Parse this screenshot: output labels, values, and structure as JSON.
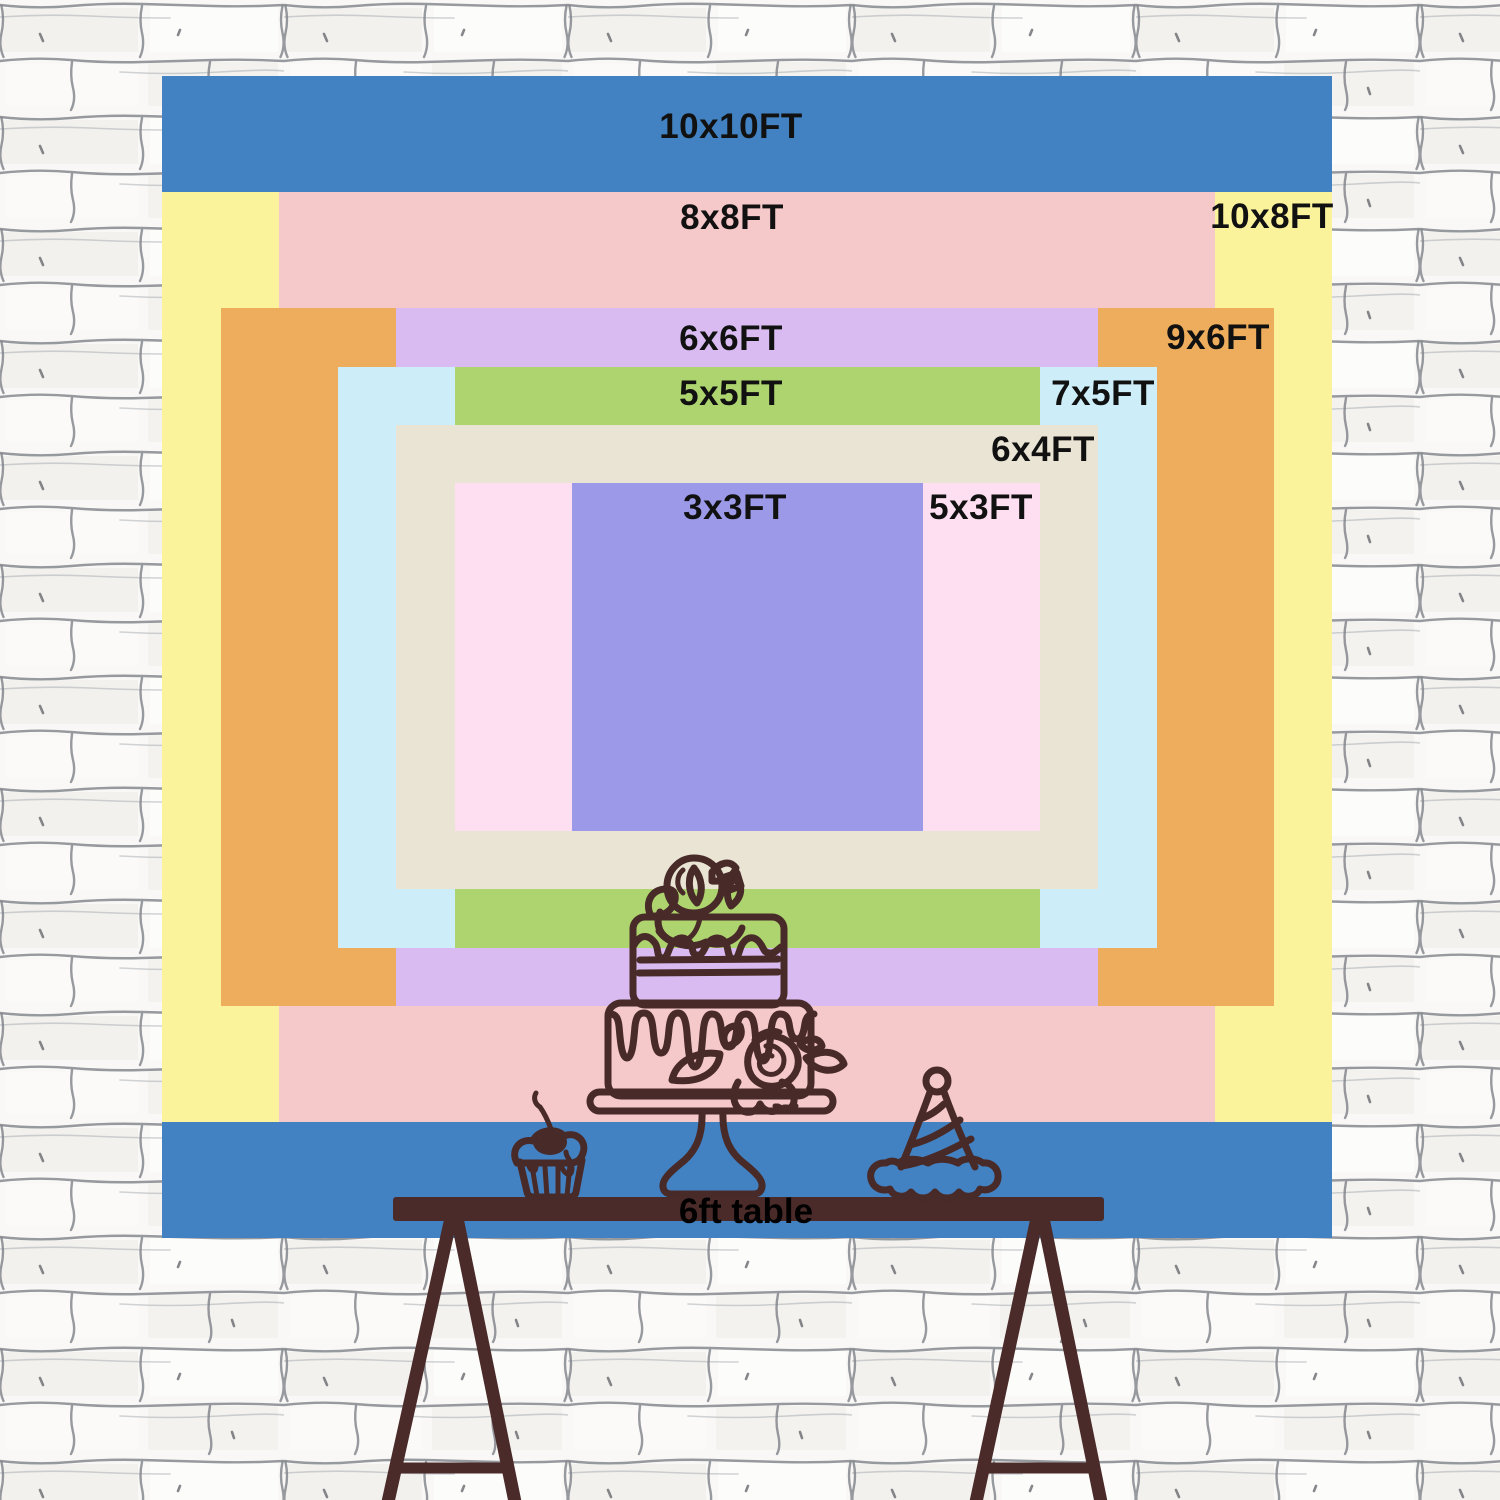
{
  "page": {
    "type": "backdrop-size-comparison-diagram",
    "background": "hand-drawn white brick wall"
  },
  "backdrop": {
    "label_color": "#111111",
    "layout": {
      "origin_x": 162,
      "origin_y": 76,
      "px_per_ft_x": 117,
      "px_per_ft_y": 116.2,
      "base_ft": 10
    },
    "sizes": [
      {
        "id": "10x10",
        "label": "10x10FT",
        "width_ft": 10,
        "height_ft": 10,
        "color": "#4282c2",
        "label_x": 731,
        "label_y": 127
      },
      {
        "id": "10x8",
        "label": "10x8FT",
        "width_ft": 10,
        "height_ft": 8,
        "color": "#fbf29c",
        "label_x": 1272,
        "label_y": 217
      },
      {
        "id": "8x8",
        "label": "8x8FT",
        "width_ft": 8,
        "height_ft": 8,
        "color": "#f5c8c9",
        "label_x": 732,
        "label_y": 218
      },
      {
        "id": "9x6",
        "label": "9x6FT",
        "width_ft": 9,
        "height_ft": 6,
        "color": "#eead5c",
        "label_x": 1218,
        "label_y": 338
      },
      {
        "id": "6x6",
        "label": "6x6FT",
        "width_ft": 6,
        "height_ft": 6,
        "color": "#d9bbf1",
        "label_x": 731,
        "label_y": 339
      },
      {
        "id": "7x5",
        "label": "7x5FT",
        "width_ft": 7,
        "height_ft": 5,
        "color": "#cdeef9",
        "label_x": 1103,
        "label_y": 394
      },
      {
        "id": "5x5",
        "label": "5x5FT",
        "width_ft": 5,
        "height_ft": 5,
        "color": "#add46e",
        "label_x": 731,
        "label_y": 394
      },
      {
        "id": "6x4",
        "label": "6x4FT",
        "width_ft": 6,
        "height_ft": 4,
        "color": "#eae4d4",
        "label_x": 1043,
        "label_y": 450
      },
      {
        "id": "5x3",
        "label": "5x3FT",
        "width_ft": 5,
        "height_ft": 3,
        "color": "#fddff1",
        "label_x": 981,
        "label_y": 508
      },
      {
        "id": "3x3",
        "label": "3x3FT",
        "width_ft": 3,
        "height_ft": 3,
        "color": "#9c99e8",
        "label_x": 735,
        "label_y": 508
      }
    ]
  },
  "table": {
    "label": "6ft table",
    "wood_color": "#4a2b29",
    "label_color": "#000000"
  },
  "illustration": {
    "stroke_color": "#482a29",
    "items": [
      "tiered-cake",
      "cupcake",
      "party-hat"
    ]
  }
}
